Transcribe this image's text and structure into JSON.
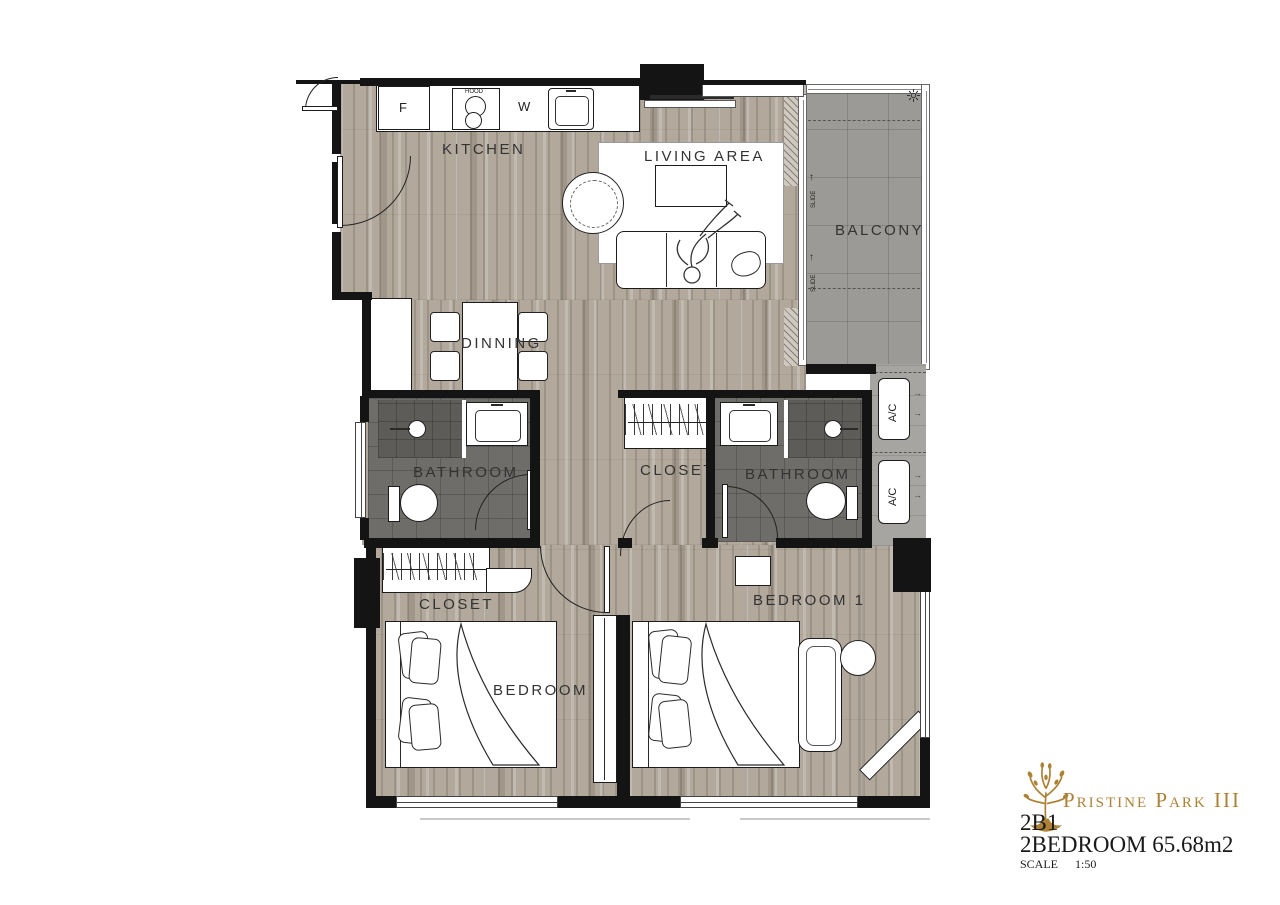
{
  "title_block": {
    "brand": "Pristine Park III",
    "unit_code": "2B1",
    "unit_desc": "2BEDROOM 65.68m2",
    "scale_label": "SCALE",
    "scale_value": "1:50"
  },
  "labels": {
    "kitchen": "KITCHEN",
    "living_area": "LIVING AREA",
    "balcony": "BALCONY",
    "dining": "DINNING",
    "bathroom_left": "BATHROOM",
    "bathroom_right": "BATHROOM",
    "closet_hall": "CLOSET",
    "closet_bedroom2": "CLOSET",
    "bedroom1": "BEDROOM 1",
    "bedroom2": "BEDROOM 2",
    "fridge": "F",
    "washer": "W",
    "hood": "HOOD",
    "ac_top": "A/C",
    "ac_bottom": "A/C",
    "slide_top": "SLIDE",
    "slide_bottom": "SLIDE",
    "arrow_up": "↑",
    "arrow_right": "→"
  },
  "colors": {
    "brand_gold": "#ad8236",
    "wall_black": "#141414",
    "wood_floor": "#b2a99c",
    "balcony_tile": "#9b9a96",
    "bathroom_tile": "#6e6d6a",
    "label_text": "#333333"
  }
}
